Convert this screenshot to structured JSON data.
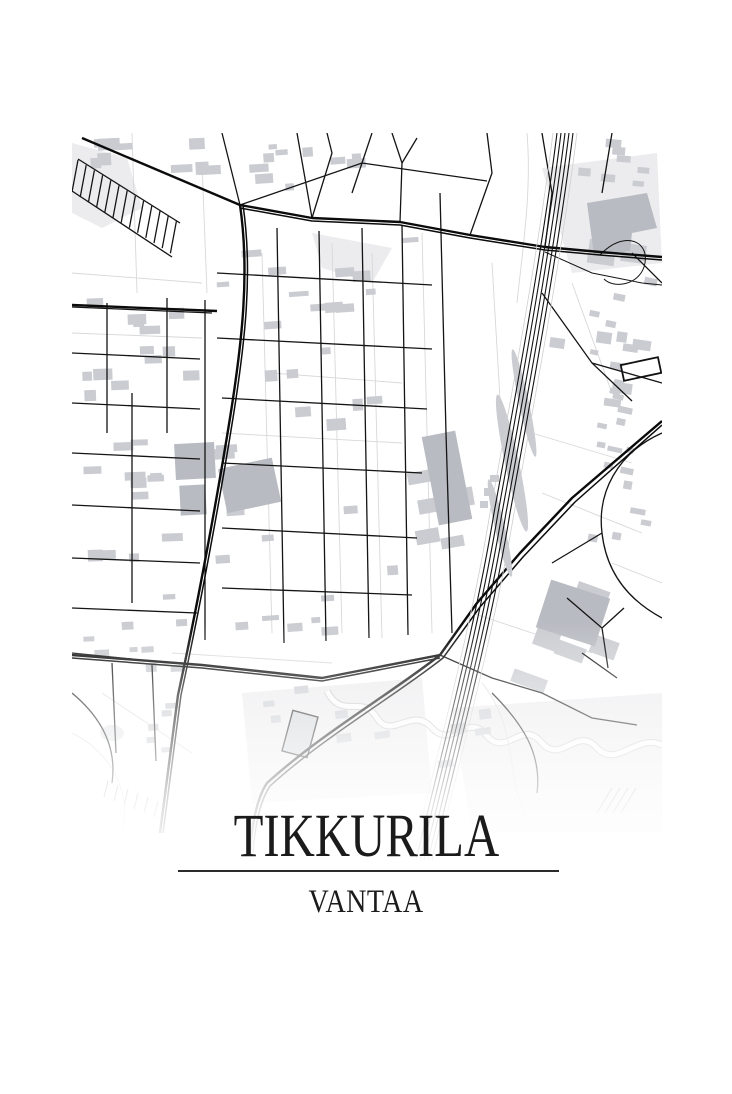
{
  "poster": {
    "title": "TIKKURILA",
    "subtitle": "VANTAA"
  },
  "colors": {
    "background": "#ffffff",
    "road": "#141414",
    "road_major": "#0b0b0b",
    "building": "#caccd1",
    "building_dark": "#b8bbc1",
    "parcel_line": "#d8d8da",
    "water_edge": "#c6c6c8",
    "park": "#ececee",
    "text": "#1b1b1b",
    "divider": "#2b2b2b"
  }
}
